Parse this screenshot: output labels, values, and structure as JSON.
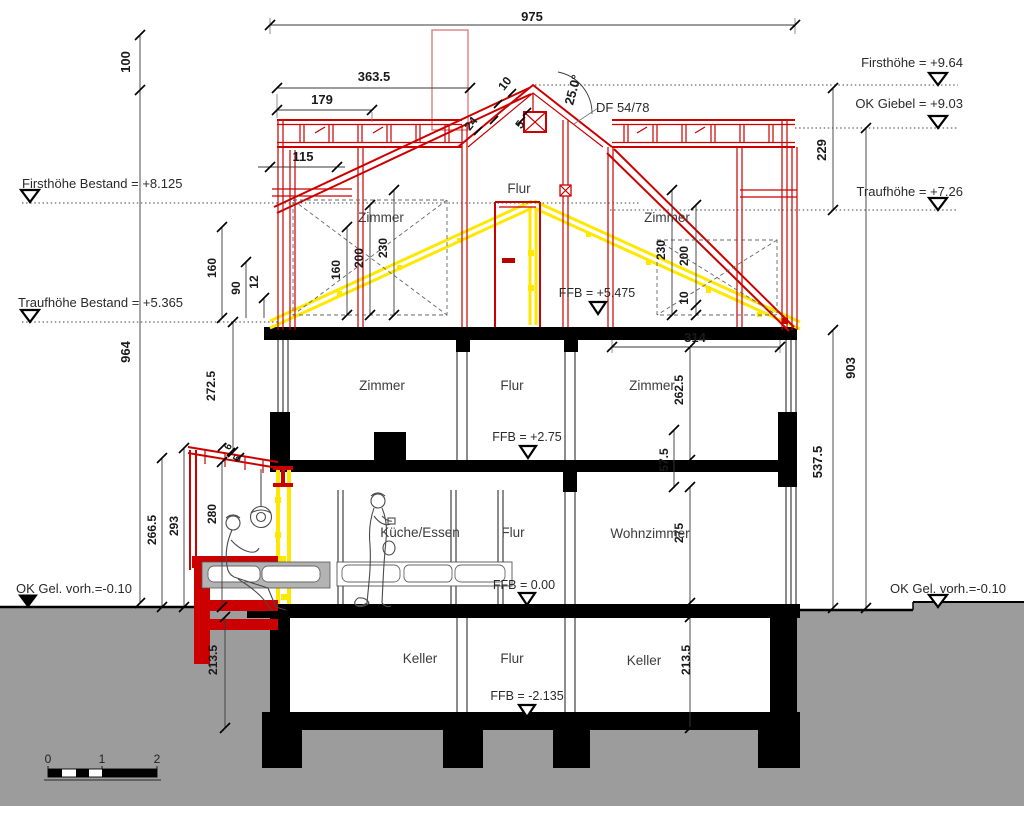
{
  "drawing": {
    "type": "building-section",
    "levels": {
      "firsthoehe_bestand": "Firsthöhe Bestand = +8.125",
      "traufhoehe_bestand": "Traufhöhe Bestand = +5.365",
      "firsthoehe": "Firsthöhe = +9.64",
      "ok_giebel": "OK Giebel = +9.03",
      "traufhoehe": "Traufhöhe = +7.26",
      "ok_gelaende_links": "OK Gel. vorh.=-0.10",
      "ok_gelaende_rechts": "OK Gel. vorh.=-0.10",
      "ffb_dachgeschoss": "FFB = +5.475",
      "ffb_obergeschoss": "FFB = +2.75",
      "ffb_erdgeschoss": "FFB = 0.00",
      "ffb_keller": "FFB = -2.135"
    },
    "rooms": {
      "dg_flur": "Flur",
      "dg_zimmer_links": "Zimmer",
      "dg_zimmer_rechts": "Zimmer",
      "og_zimmer_links": "Zimmer",
      "og_flur": "Flur",
      "og_zimmer_rechts": "Zimmer",
      "eg_kueche": "Küche/Essen",
      "eg_flur": "Flur",
      "eg_wohnzimmer": "Wohnzimmer",
      "kg_keller_links": "Keller",
      "kg_flur": "Flur",
      "kg_keller_rechts": "Keller"
    },
    "annotations": {
      "dachfenster": "DF 54/78",
      "dachneigung": "25.0°"
    },
    "dimensions": {
      "gesamtbreite": "975",
      "breite_1": "363.5",
      "breite_2": "179",
      "breite_3": "115",
      "breite_innen": "314",
      "hoehe_100": "100",
      "hoehe_964": "964",
      "traufe_160": "160",
      "traufe_90": "90",
      "traufe_12": "12",
      "links_272_5": "272.5",
      "links_266_5": "266.5",
      "links_293": "293",
      "links_280": "280",
      "terrasse_6": "6",
      "terrasse_5": "5",
      "dg_links_160": "160",
      "dg_links_200": "200",
      "dg_links_230": "230",
      "dg_rechts_230": "230",
      "dg_rechts_200": "200",
      "dg_rechts_10": "10",
      "dach_10": "10",
      "dach_24": "24",
      "dach_5": "5",
      "og_262_5": "262.5",
      "og_57_5": "57.5",
      "eg_275": "275",
      "kg_links_213_5": "213.5",
      "kg_rechts_213_5": "213.5",
      "rechts_229": "229",
      "rechts_537_5": "537.5",
      "rechts_903": "903"
    },
    "scale_bar": {
      "t0": "0",
      "t1": "1",
      "t2": "2"
    },
    "colors": {
      "neubau_rot": "#cc0000",
      "bestand_gelb": "#ffe800",
      "erdreich_grau": "#9c9c9c"
    }
  }
}
